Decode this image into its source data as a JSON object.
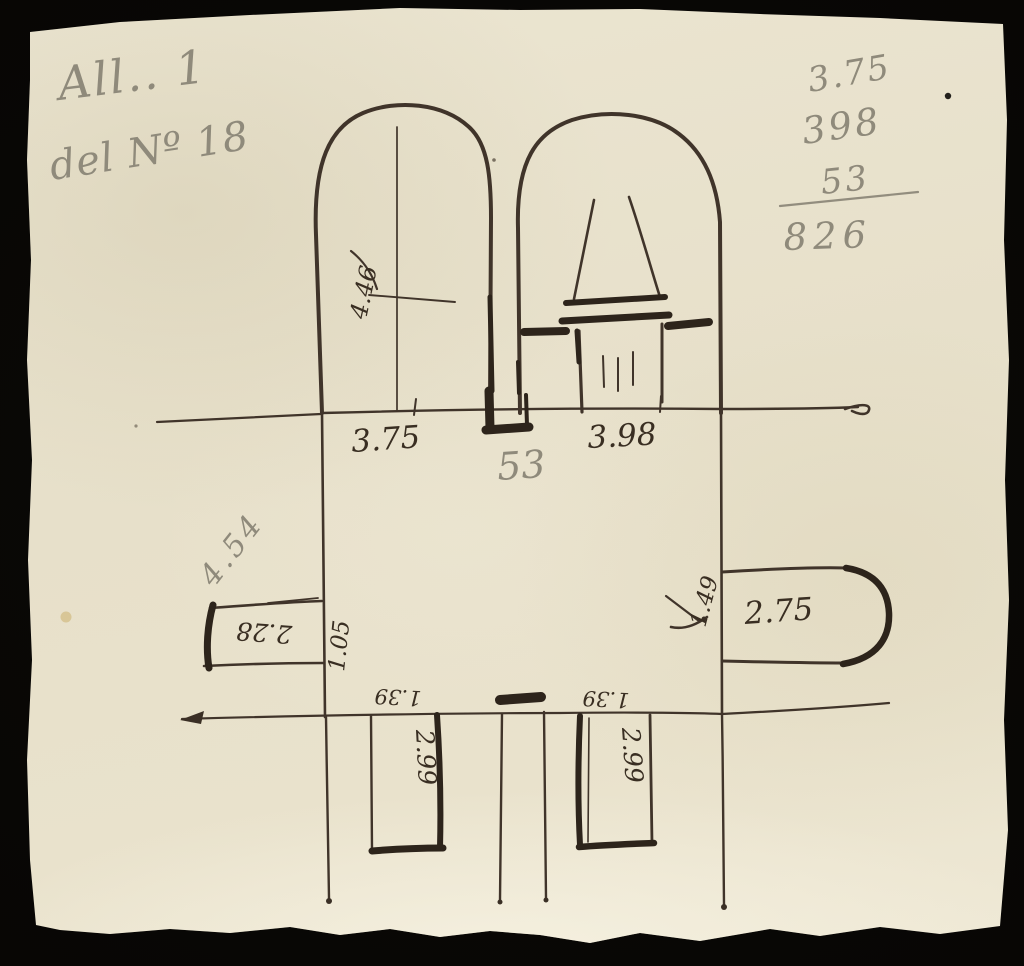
{
  "colors": {
    "background": "#050403",
    "paper": "#e9e2cd",
    "ink": "#40342a",
    "ink_heavy": "#2d241b",
    "pencil": "#8f8a7b"
  },
  "header_notes": {
    "attachment": "All.. 1",
    "reference": "del Nº 18"
  },
  "sum_notes": {
    "addend1": "3.75",
    "addend2": "398",
    "addend3": "53",
    "total": "826"
  },
  "plan_labels": {
    "left_arch_width": "3.75",
    "right_arch_width": "3.98",
    "center_gap": "53",
    "left_arch_depth": "4.46",
    "left_wall_note": "4.54",
    "left_niche_length": "2.28",
    "left_niche_depth": "1.05",
    "right_apse_length": "2.75",
    "right_apse_depth": "1.49",
    "bottom_left_room_length": "2.99",
    "bottom_right_room_length": "2.99",
    "bottom_left_wall_depth": "1.39",
    "bottom_right_wall_depth": "1.39"
  }
}
